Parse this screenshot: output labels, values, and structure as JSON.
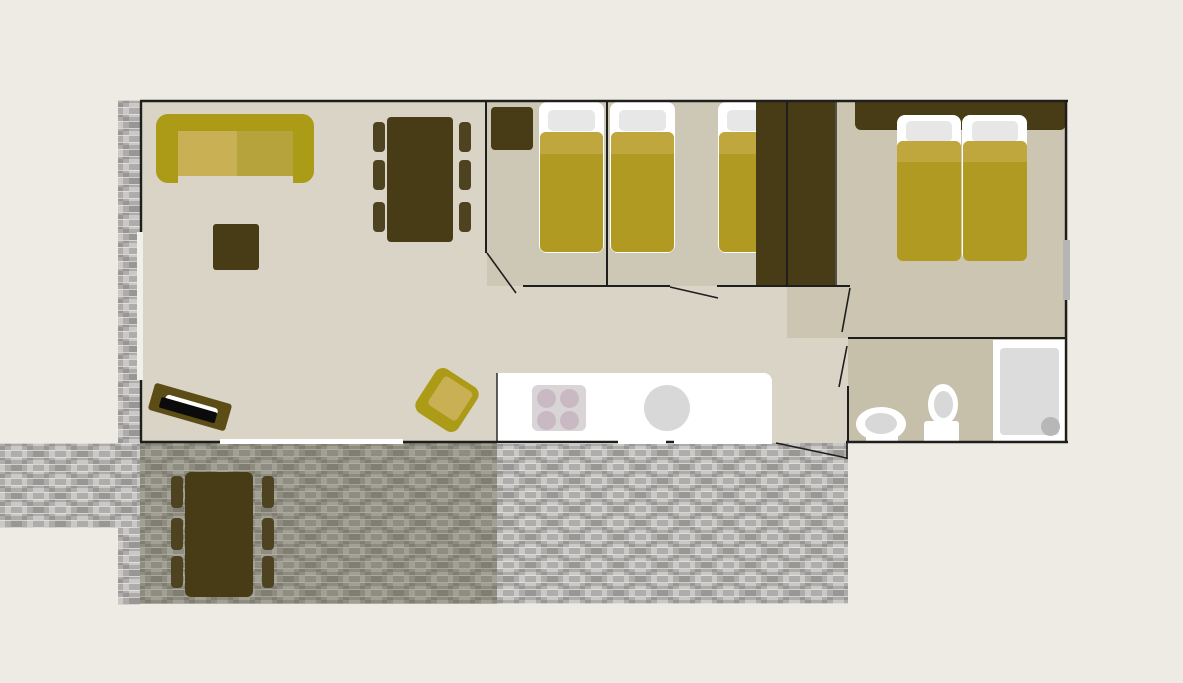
{
  "diagram": {
    "type": "floor-plan",
    "subject": "holiday-mobile-home-with-terrace",
    "rooms": [
      {
        "name": "living-room",
        "furniture": [
          "sofa",
          "coffee-table",
          "dining-table",
          "six-dining-chairs",
          "tv-cabinet",
          "armchair"
        ]
      },
      {
        "name": "kitchen",
        "furniture": [
          "counter",
          "four-burner-hob",
          "round-sink"
        ]
      },
      {
        "name": "hallway",
        "furniture": []
      },
      {
        "name": "bedroom-1",
        "furniture": [
          "single-bed",
          "bedside-cabinet"
        ]
      },
      {
        "name": "bedroom-2",
        "furniture": [
          "single-bed",
          "single-bed",
          "wardrobe"
        ]
      },
      {
        "name": "bedroom-3",
        "furniture": [
          "double-bed-two-mattresses",
          "headboard",
          "wardrobe"
        ]
      },
      {
        "name": "bathroom",
        "furniture": [
          "washbasin",
          "toilet",
          "shower"
        ]
      },
      {
        "name": "terrace",
        "furniture": [
          "picnic-table",
          "six-outdoor-chairs"
        ]
      },
      {
        "name": "garden-path",
        "furniture": []
      }
    ],
    "openings": [
      "patio-opening-living-room-to-terrace",
      "kitchen-door-to-terrace",
      "entrance-door-with-swing",
      "bedroom-1-door-swing",
      "bedroom-2-door-swing",
      "bedroom-3-door-swing",
      "bathroom-door-swing",
      "window-left-wall",
      "window-right-wall"
    ],
    "bed_count": {
      "single_beds": 3,
      "double_beds": 1
    }
  },
  "colors": {
    "background": "#edebe4",
    "floor_base": "#d9d4c6",
    "floor_bedroom": "#cdc7b5",
    "floor_bedroom3": "#cbc5b1",
    "floor_bathroom": "#c6c0ab",
    "wall_line": "#1e1e1d",
    "dark_wood": "#483c16",
    "chair_wood": "#4e4320",
    "tv_wood": "#5c4c15",
    "tv_screen": "#0b0b0b",
    "sofa_frame": "#ab9b17",
    "cushion_left": "#c9b055",
    "cushion_right": "#b7a33c",
    "mattress": "#ffffff",
    "pillow": "#e7e7e7",
    "blanket": "#b09a22",
    "blanket_top": "#bfa73e",
    "fixture_white": "#ffffff",
    "fixture_gray": "#d8d8d8",
    "shower_tray": "#dcdcdc",
    "drain_gray": "#b7b7b7",
    "hob_bg": "#d9d5d7",
    "hob_burner": "#c9b9c3",
    "tile_light": "#cac9c7",
    "tile_mid": "#aeadab",
    "deck_shadow": "rgba(77,71,41,0.32)",
    "window_left": "#f0efe9",
    "window_right": "#b5b5b3"
  }
}
